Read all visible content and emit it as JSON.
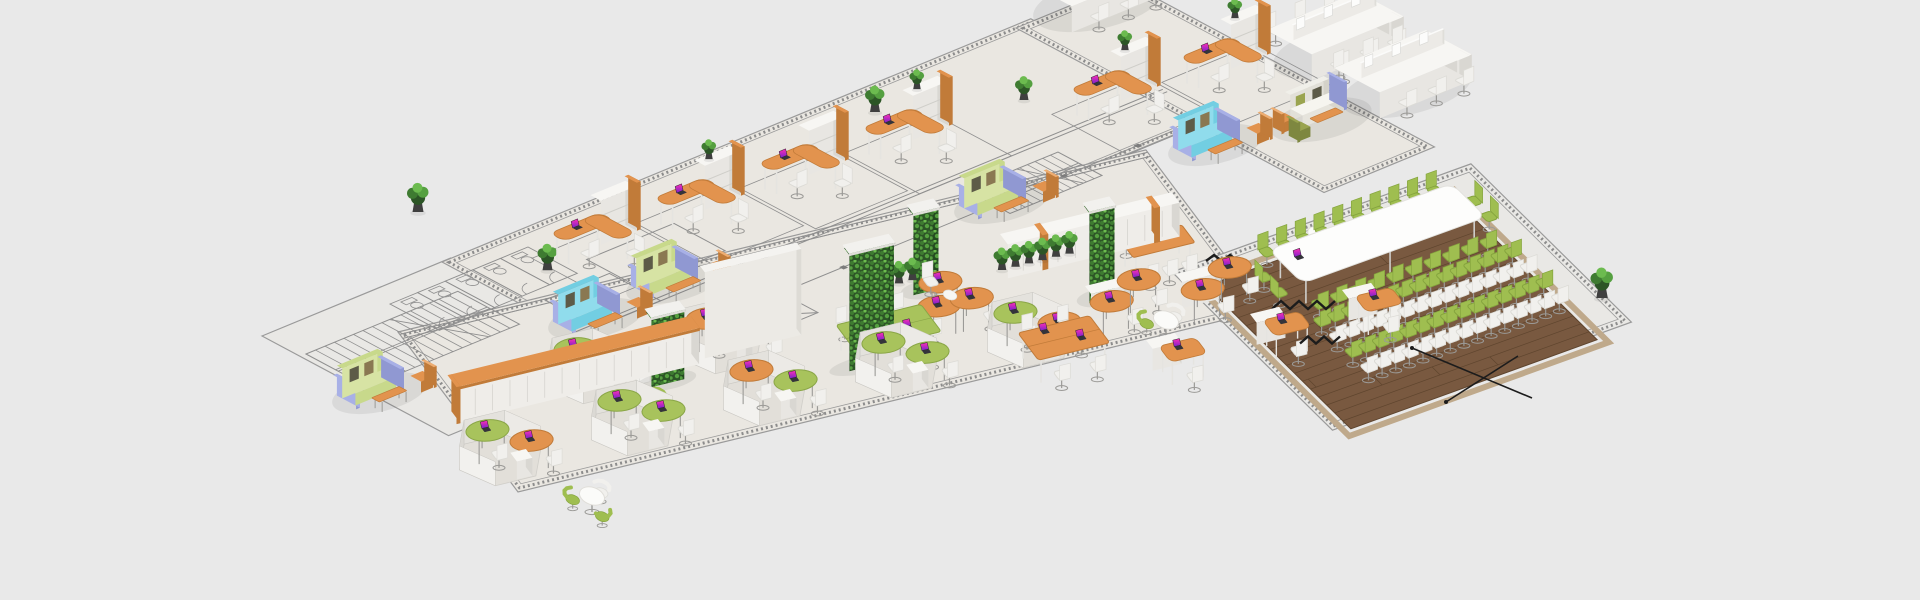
{
  "canvas": {
    "width": 1920,
    "height": 600,
    "background": "#e9e9e9"
  },
  "palette": {
    "bg": "#e9e9e9",
    "floor": "#eae7e1",
    "floorAnnex": "#e9e8e5",
    "floorInner": "#e2dfd9",
    "outline": "#9a9a9a",
    "blueprint": "#8f8f8f",
    "hatch": "#8c8c8c",
    "column": "#7c7c7c",
    "orangeTop": "#e2934e",
    "orangeSide": "#c17b39",
    "orangeLight": "#edad72",
    "whiteTop": "#f7f6f3",
    "whiteA": "#e8e6e2",
    "whiteB": "#d9d7d2",
    "grayInner": "#d4d2cd",
    "greenTop": "#a8c35c",
    "greenSide": "#8aa647",
    "chairWhite": "#f1f0ed",
    "chairWhiteSide": "#dcdbd6",
    "chairGreen": "#9fbe50",
    "chairGreenSide": "#85a43e",
    "sofaGreen": "#c8d98b",
    "sofaGreenLight": "#d7e3a4",
    "cyan": "#72cee2",
    "cyanLight": "#90dcec",
    "lavender": "#a8b0e6",
    "lavenderSide": "#9098d2",
    "olive": "#9aa44f",
    "pillowDark": "#5d5b48",
    "pillowTan": "#8a7852",
    "metal": "#9b9a97",
    "legWhite": "#e5e4e0",
    "wood": "#795940",
    "plank": "#5f452e",
    "woodEdge": "#bfa98b",
    "leafBase": "#2c5526",
    "leaf1": "#3e7b31",
    "leaf2": "#55a040",
    "leaf3": "#6cbb4f",
    "leafSideBase": "#234a1f",
    "potColor": "#3f3f3f",
    "cable": "#1c1c1c",
    "lcdTop": "#ff2fb4",
    "lcdBottom": "#7a22cc",
    "laptopBody": "#34343a",
    "shadow": "rgba(60,60,60,0.09)"
  },
  "frames": {
    "upper": {
      "A": [
        0.92,
        -0.38
      ],
      "B": [
        0.88,
        0.47
      ]
    },
    "lower": {
      "A": [
        0.965,
        -0.235
      ],
      "B": [
        0.6,
        0.8
      ]
    },
    "conf": {
      "A": [
        0.94,
        -0.34
      ],
      "B": [
        0.71,
        0.7
      ]
    }
  },
  "floors": [
    {
      "name": "annex-blueprint-floor",
      "frame": "upper",
      "o": [
        262,
        336
      ],
      "w": 205,
      "d": 212,
      "fill": "floorAnnex",
      "hatch": false
    },
    {
      "name": "main-strip-floor",
      "frame": "upper",
      "o": [
        442,
        262
      ],
      "w": 640,
      "d": 210,
      "fill": "floor",
      "hatch": true
    },
    {
      "name": "east-wing-floor",
      "frame": "upper",
      "o": [
        1016,
        28
      ],
      "w": 120,
      "d": 350,
      "fill": "floor",
      "hatch": true
    },
    {
      "name": "openplan-floor",
      "frame": "lower",
      "o": [
        398,
        332
      ],
      "w": 775,
      "d": 200,
      "fill": "floor",
      "hatch": true
    },
    {
      "name": "conference-zone-floor",
      "frame": "conf",
      "o": [
        1172,
        272
      ],
      "w": 318,
      "d": 226,
      "fill": "floorAnnex",
      "hatch": true
    }
  ],
  "wood": {
    "name": "conference-wood-floor",
    "o": [
      1206,
      286
    ],
    "w": 262,
    "d": 204,
    "planks": 18
  },
  "blueprint": {
    "stairs": [
      {
        "o": [
          306,
          354
        ],
        "len": 165,
        "wd": 70,
        "n": 16
      },
      {
        "o": [
          966,
          190
        ],
        "len": 100,
        "wd": 50,
        "n": 12
      }
    ],
    "wcrow": {
      "o": [
        390,
        304
      ],
      "stalls": 5,
      "stallW": 30,
      "stallD": 56
    },
    "rooms": {
      "o": [
        545,
        300
      ],
      "rects": [
        [
          0,
          0,
          70,
          58
        ],
        [
          72,
          -28,
          95,
          58
        ]
      ]
    },
    "xroom": {
      "o": [
        704,
        318
      ],
      "w": 76,
      "d": 50
    },
    "tracksUpper": {
      "o": [
        442,
        262
      ],
      "lines": [
        [
          0,
          150,
          640,
          150
        ],
        [
          0,
          155,
          640,
          155
        ],
        [
          0,
          205,
          640,
          205
        ]
      ],
      "columns": 7
    },
    "tracksLower": {
      "o": [
        398,
        332
      ],
      "lines": [
        [
          0,
          3,
          775,
          3
        ],
        [
          0,
          8,
          775,
          8
        ]
      ]
    }
  },
  "conference": {
    "o": [
      1206,
      286
    ],
    "table": {
      "a": 56,
      "b": 14,
      "w": 195,
      "d": 48,
      "h": 27
    },
    "sideChairs": 10,
    "endChairs": 2,
    "audience": {
      "rows": 4,
      "perRow": 15,
      "a0": 52,
      "aStep": 14.5,
      "b0": 94,
      "bStep": 22,
      "rowColors": [
        "green",
        "white",
        "green",
        "white"
      ]
    }
  },
  "items": [
    {
      "t": "cell",
      "n": "office-cell-1",
      "f": "upper",
      "o": [
        548,
        260
      ],
      "pot": true
    },
    {
      "t": "cell",
      "n": "office-cell-2",
      "f": "upper",
      "o": [
        652,
        225
      ],
      "plant": true
    },
    {
      "t": "cell",
      "n": "office-cell-3",
      "f": "upper",
      "o": [
        756,
        190
      ]
    },
    {
      "t": "cell",
      "n": "office-cell-4",
      "f": "upper",
      "o": [
        860,
        155
      ],
      "plant": true
    },
    {
      "t": "cell",
      "n": "office-cell-5",
      "f": "upper",
      "o": [
        1068,
        116
      ],
      "plant": true
    },
    {
      "t": "cell",
      "n": "office-cell-6",
      "f": "upper",
      "o": [
        1178,
        84
      ],
      "plant": true
    },
    {
      "t": "benchcluster",
      "n": "bench-cluster-top",
      "f": "upper",
      "o": [
        1026,
        8
      ]
    },
    {
      "t": "benchcluster",
      "n": "bench-cluster-1",
      "f": "upper",
      "o": [
        1266,
        56
      ]
    },
    {
      "t": "benchcluster",
      "n": "bench-cluster-2",
      "f": "upper",
      "o": [
        1334,
        94
      ]
    },
    {
      "t": "booth",
      "n": "lounge-booth-green-1",
      "f": "upper",
      "o": [
        336,
        396
      ],
      "c": "green"
    },
    {
      "t": "booth",
      "n": "lounge-booth-cyan-1",
      "f": "upper",
      "o": [
        552,
        322
      ],
      "c": "cyan"
    },
    {
      "t": "booth",
      "n": "lounge-booth-green-2",
      "f": "upper",
      "o": [
        630,
        286
      ],
      "c": "green"
    },
    {
      "t": "booth",
      "n": "lounge-booth-green-3",
      "f": "upper",
      "o": [
        958,
        206
      ],
      "c": "green"
    },
    {
      "t": "booth",
      "n": "lounge-booth-cyan-2",
      "f": "upper",
      "o": [
        1172,
        148
      ],
      "c": "cyan"
    },
    {
      "t": "loungeset",
      "n": "lounge-sofa-set",
      "f": "upper",
      "o": [
        1285,
        118
      ]
    },
    {
      "t": "pot",
      "n": "potted-plant",
      "o": [
        418,
        212
      ],
      "s": 1.1
    },
    {
      "t": "pot",
      "n": "potted-plant",
      "o": [
        875,
        112
      ],
      "s": 1.0
    },
    {
      "t": "pot",
      "n": "potted-plant",
      "o": [
        1024,
        100
      ],
      "s": 0.9
    },
    {
      "t": "pot",
      "n": "potted-plant",
      "o": [
        1602,
        298
      ],
      "s": 1.15
    },
    {
      "t": "wall",
      "n": "white-wall",
      "f": "lower",
      "o": [
        700,
        352
      ],
      "len": 100,
      "h": 86
    },
    {
      "t": "plantwall",
      "n": "plant-wall-1",
      "f": "lower",
      "o": [
        646,
        380
      ],
      "wd": 34,
      "h": 68
    },
    {
      "t": "plantwall",
      "n": "plant-wall-2",
      "f": "lower",
      "o": [
        844,
        364
      ],
      "wd": 46,
      "h": 116
    },
    {
      "t": "plantwall",
      "n": "plant-wall-3",
      "f": "lower",
      "o": [
        908,
        288
      ],
      "wd": 26,
      "h": 80
    },
    {
      "t": "plantwall",
      "n": "plant-wall-4",
      "f": "lower",
      "o": [
        1084,
        296
      ],
      "wd": 26,
      "h": 90
    },
    {
      "t": "cabrow",
      "n": "cabinet-row-orange-cap",
      "f": "lower",
      "o": [
        452,
        412
      ],
      "len": 248,
      "cap": true
    },
    {
      "t": "cabrow",
      "n": "cabinet-row-accent",
      "f": "lower",
      "o": [
        1000,
        268
      ],
      "len": 178,
      "accents": true
    },
    {
      "t": "potrow",
      "n": "plant-row-1",
      "f": "lower",
      "o": [
        872,
        290
      ],
      "nPots": 4
    },
    {
      "t": "potrow",
      "n": "plant-row-2",
      "f": "lower",
      "o": [
        1002,
        270
      ],
      "nPots": 6
    },
    {
      "t": "pod",
      "n": "hex-pod",
      "f": "lower",
      "o": [
        500,
        460
      ],
      "d1": "green",
      "d2": "orange"
    },
    {
      "t": "pod",
      "n": "hex-pod",
      "f": "lower",
      "o": [
        632,
        430
      ],
      "d1": "green",
      "d2": "green"
    },
    {
      "t": "pod",
      "n": "hex-pod",
      "f": "lower",
      "o": [
        764,
        400
      ],
      "d1": "orange",
      "d2": "green"
    },
    {
      "t": "pod",
      "n": "hex-pod",
      "f": "lower",
      "o": [
        896,
        372
      ],
      "d1": "green",
      "d2": "green"
    },
    {
      "t": "pod",
      "n": "hex-pod",
      "f": "lower",
      "o": [
        588,
        378
      ],
      "d1": "green",
      "d2": "orange"
    },
    {
      "t": "pod",
      "n": "hex-pod",
      "f": "lower",
      "o": [
        720,
        348
      ],
      "d1": "orange",
      "d2": "green"
    },
    {
      "t": "pod",
      "n": "hex-pod",
      "f": "lower",
      "o": [
        1028,
        342
      ],
      "d1": "green",
      "d2": "orange"
    },
    {
      "t": "bench4",
      "n": "green-bench-desk",
      "f": "lower",
      "o": [
        836,
        350
      ],
      "c": "green",
      "len": 88,
      "seats": 6
    },
    {
      "t": "bench4",
      "n": "orange-bench-desk",
      "f": "lower",
      "o": [
        1018,
        358
      ],
      "c": "orange",
      "len": 74,
      "seats": 4
    },
    {
      "t": "pinwheel",
      "n": "orange-desk-pinwheel",
      "f": "lower",
      "o": [
        950,
        320
      ]
    },
    {
      "t": "meettable",
      "n": "orange-meeting-table",
      "f": "lower",
      "o": [
        1120,
        266
      ]
    },
    {
      "t": "ldeskpair",
      "n": "kidney-desk-cluster",
      "f": "lower",
      "o": [
        1085,
        312
      ]
    },
    {
      "t": "ldeskpair",
      "n": "kidney-desk-cluster",
      "f": "lower",
      "o": [
        1176,
        300
      ]
    },
    {
      "t": "deskunit",
      "n": "orange-desk-unit",
      "f": "lower",
      "o": [
        1146,
        362
      ]
    },
    {
      "t": "deskunit",
      "n": "orange-desk-unit",
      "f": "lower",
      "o": [
        1250,
        336
      ]
    },
    {
      "t": "deskunit",
      "n": "orange-desk-unit",
      "f": "lower",
      "o": [
        1342,
        312
      ]
    },
    {
      "t": "roundtable",
      "n": "round-meeting-table",
      "f": "lower",
      "o": [
        592,
        512
      ],
      "tubs": [
        "green",
        "white",
        "green"
      ]
    },
    {
      "t": "roundtable",
      "n": "round-meeting-table",
      "f": "lower",
      "o": [
        648,
        420
      ],
      "tubs": [
        "white",
        "green"
      ]
    },
    {
      "t": "roundtable",
      "n": "round-meeting-table",
      "f": "lower",
      "o": [
        1166,
        336
      ],
      "tubs": [
        "green",
        "white"
      ]
    },
    {
      "t": "cafetable",
      "n": "cafe-table",
      "f": "lower",
      "o": [
        1318,
        250
      ]
    },
    {
      "t": "zigzag",
      "n": "floor-cable-zigzag",
      "o": [
        1272,
        305
      ],
      "nZ": 7,
      "dx": 9,
      "amp": 8
    },
    {
      "t": "zigzag",
      "n": "floor-cable-zigzag",
      "o": [
        1206,
        258
      ],
      "nZ": 4,
      "dx": 8,
      "amp": 6
    },
    {
      "t": "zigzag",
      "n": "floor-cable-zigzag",
      "o": [
        1300,
        340
      ],
      "nZ": 5,
      "dx": 8,
      "amp": 7
    },
    {
      "t": "cable",
      "n": "floor-cable",
      "o": [
        1412,
        348
      ],
      "pts": [
        [
          1412,
          348
        ],
        [
          1532,
          398
        ]
      ]
    },
    {
      "t": "cable",
      "n": "floor-cable",
      "o": [
        1446,
        402
      ],
      "pts": [
        [
          1446,
          402
        ],
        [
          1518,
          356
        ]
      ]
    }
  ]
}
